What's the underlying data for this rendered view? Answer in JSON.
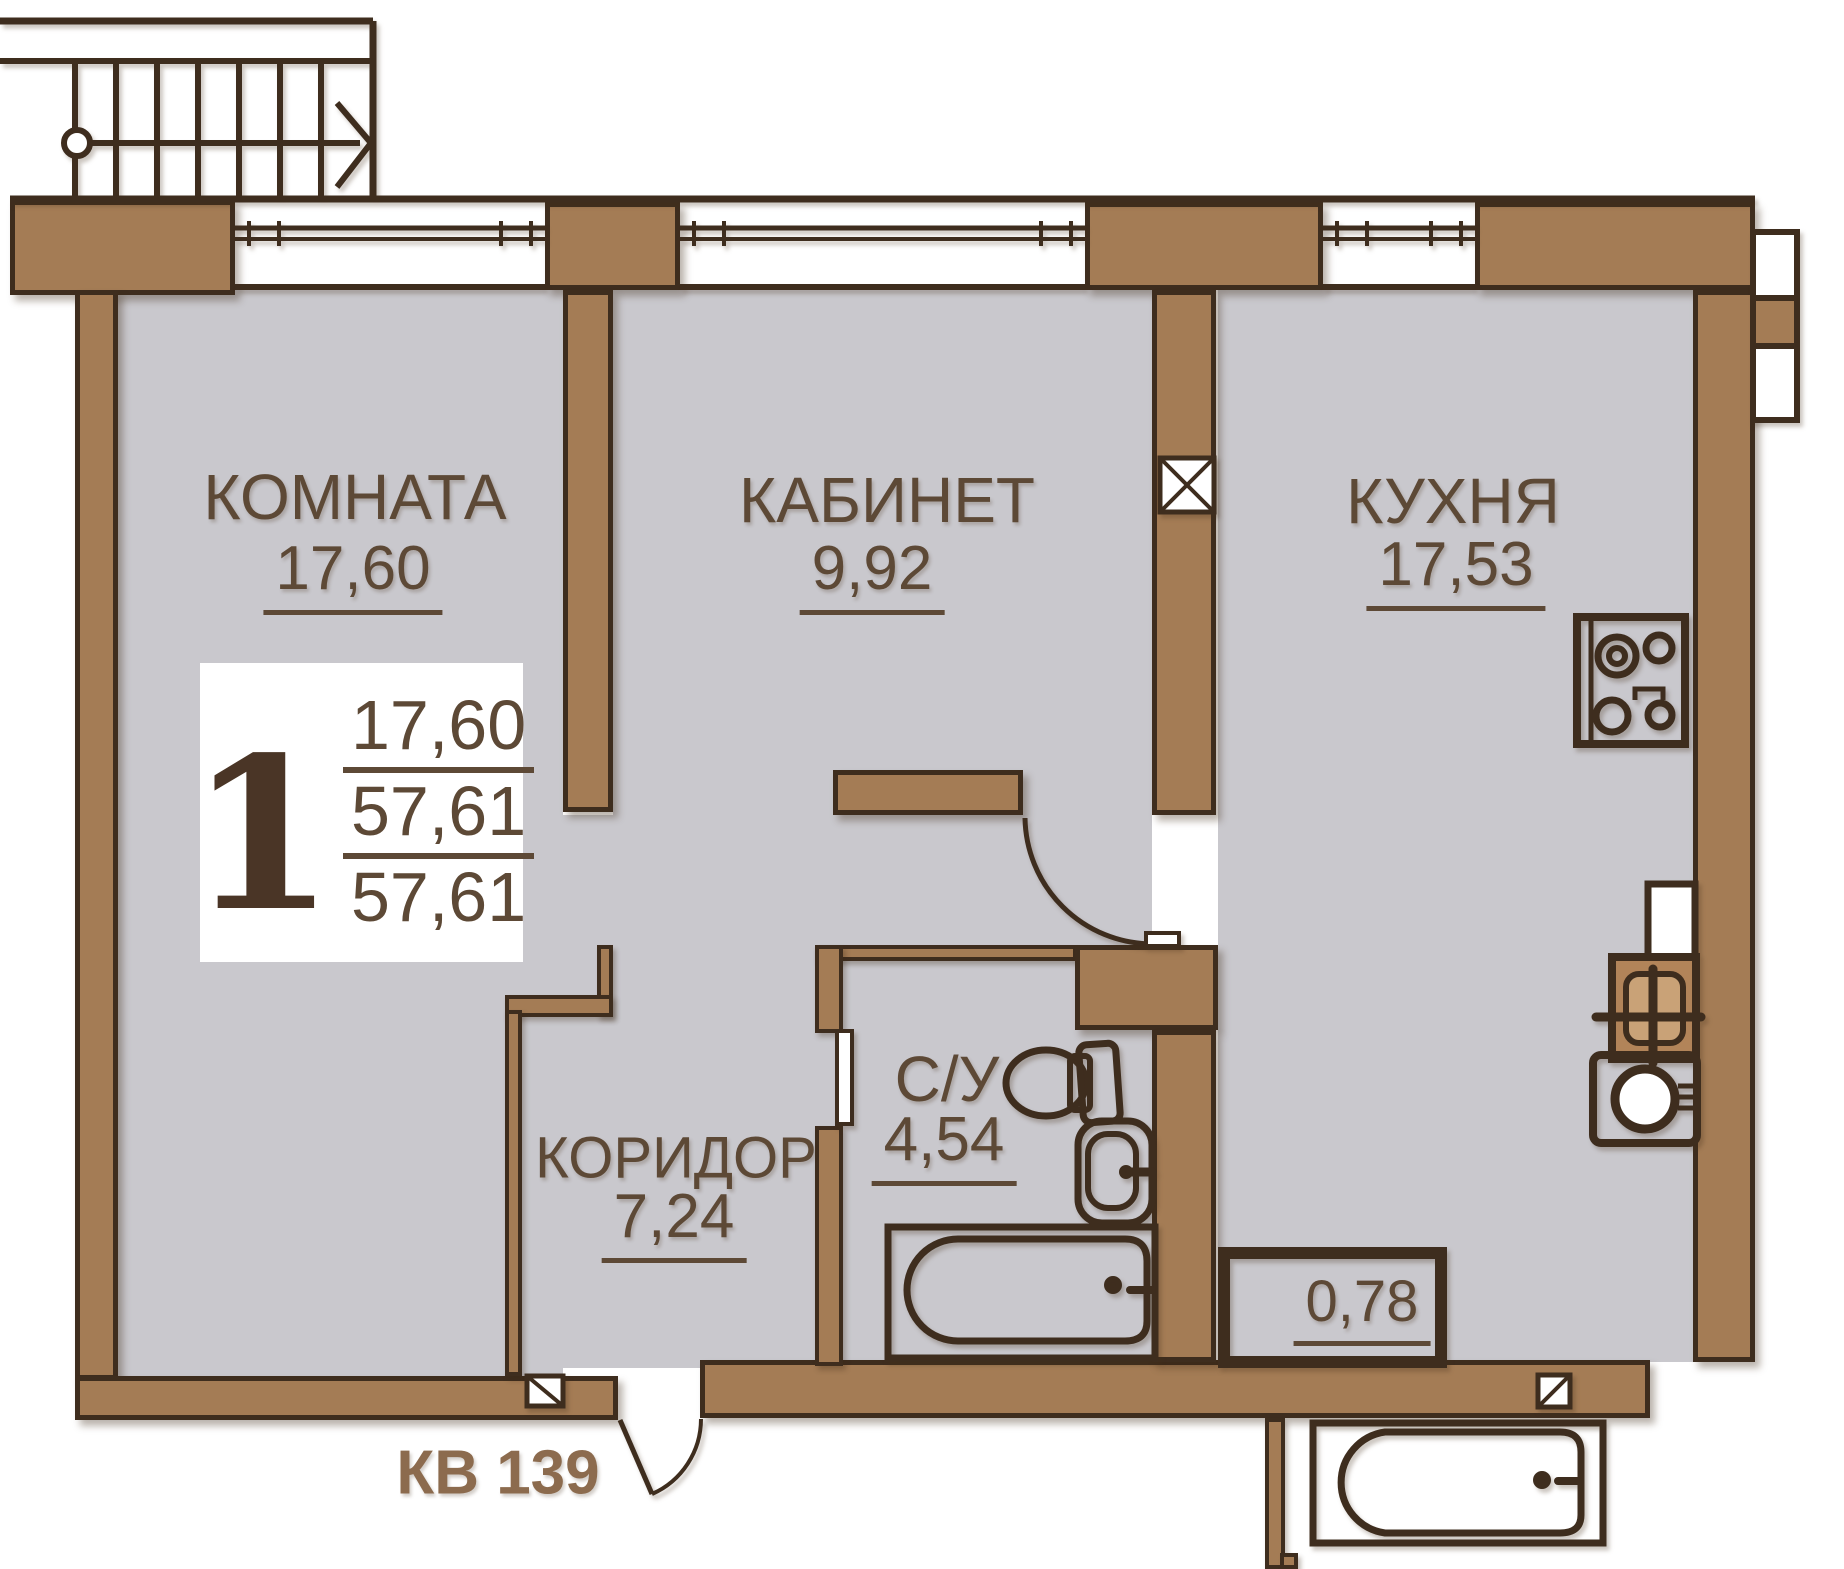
{
  "unit": {
    "number": "КВ 139",
    "badge": {
      "rooms": "1",
      "living_area": "17,60",
      "total_area": "57,61",
      "total_with_summer": "57,61"
    }
  },
  "rooms": {
    "komnata": {
      "name": "КОМНАТА",
      "area": "17,60"
    },
    "kabinet": {
      "name": "КАБИНЕТ",
      "area": "9,92"
    },
    "kuhnya": {
      "name": "КУХНЯ",
      "area": "17,53"
    },
    "su": {
      "name": "С/У",
      "area": "4,54"
    },
    "koridor": {
      "name": "КОРИДОР",
      "area": "7,24"
    },
    "balcony": {
      "area": "0,78"
    }
  },
  "colors": {
    "wall_fill": "#a47c55",
    "wall_outline": "#3e2d1e",
    "floor": "#c9c8cd",
    "label_text": "#5d4936",
    "unit_text": "#8c6b4e",
    "badge_text": "#4a3526"
  }
}
